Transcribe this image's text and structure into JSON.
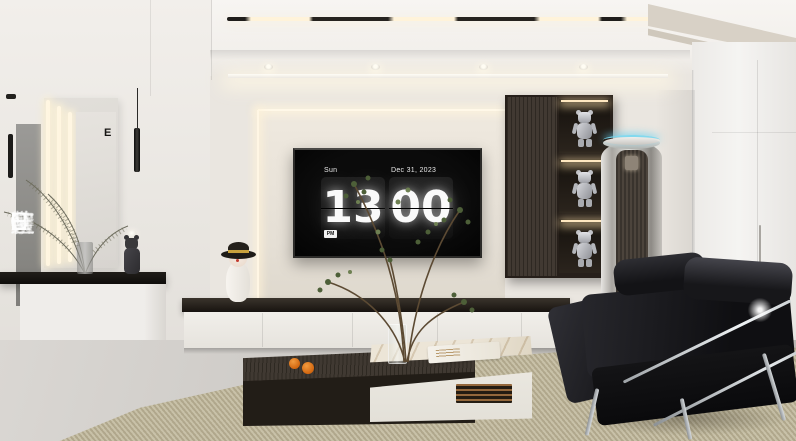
{
  "scene": {
    "title": "Modern minimalist living room render",
    "description": "White living room with flip-clock TV wall, dark display cabinet with figurines, tower air conditioner, black leather sofa, two-tier coffee tables and beige woven rug"
  },
  "watermark": {
    "text": "INTELLIGENCE HOME 智造家整装"
  },
  "tv": {
    "clock": {
      "day": "Sun",
      "date": "Dec 31, 2023",
      "hour": "13",
      "minute": "00",
      "meridiem": "PM"
    }
  },
  "mirror": {
    "mark": "E"
  },
  "colors": {
    "wall": "#eae6e0",
    "ceiling": "#f6f4f1",
    "cabinet_wood": "#3b332b",
    "clock_digits": "#fafafa",
    "screen": "#060606",
    "rug": "#c2ba9e",
    "floor": "#c8c5c1",
    "sofa": "#17171a",
    "niche_light": "#ffe8c0",
    "ac_ring": "#78d7f0",
    "orange": "#d2660f",
    "hat_band": "#c9a23d"
  }
}
